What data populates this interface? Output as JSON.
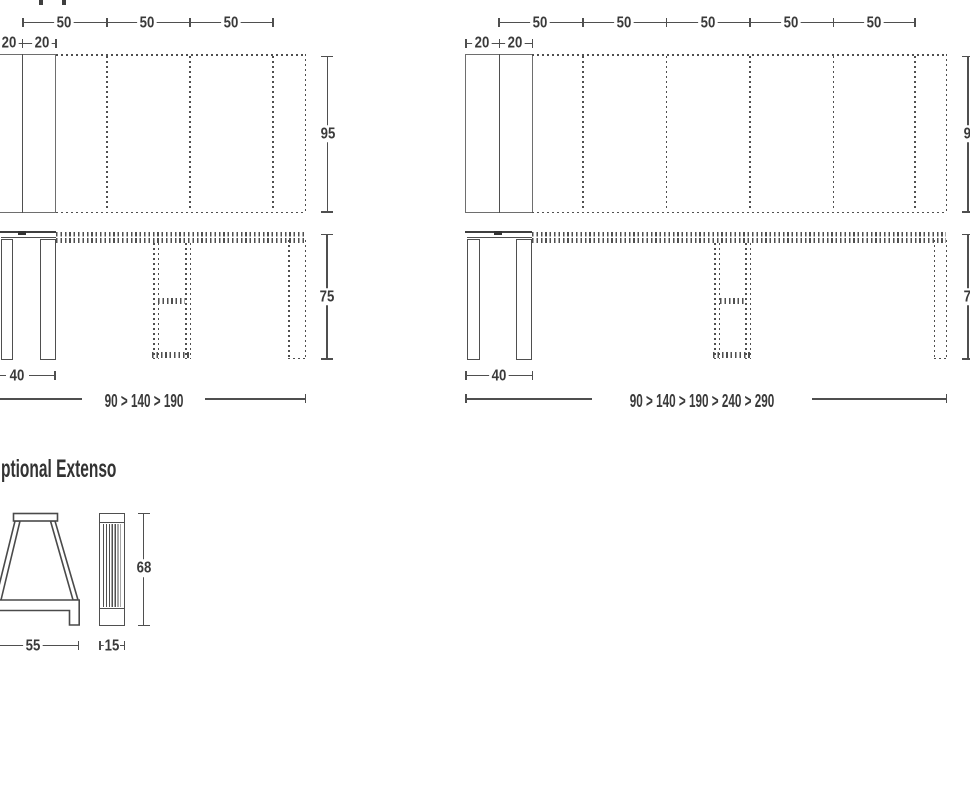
{
  "colors": {
    "line": "#4f4f4f",
    "text": "#3a3a3a"
  },
  "left_table": {
    "top_dim_labels": [
      "50",
      "50",
      "50"
    ],
    "end_dim_labels": [
      "20",
      "20"
    ],
    "depth_label": "95",
    "height_label": "75",
    "leg_span_label": "40",
    "stages_label": "90 > 140 > 190"
  },
  "right_table": {
    "top_dim_labels": [
      "50",
      "50",
      "50",
      "50",
      "50"
    ],
    "end_dim_labels": [
      "20",
      "20"
    ],
    "depth_label": "95",
    "height_label": "75",
    "leg_span_label": "40",
    "stages_label": "90 > 140 > 190 > 240 > 290"
  },
  "optional_extenso": {
    "title": "ptional Extenso",
    "trestle_height_label": "68",
    "trestle_depth_label": "55",
    "trestle_width_label": "15"
  }
}
